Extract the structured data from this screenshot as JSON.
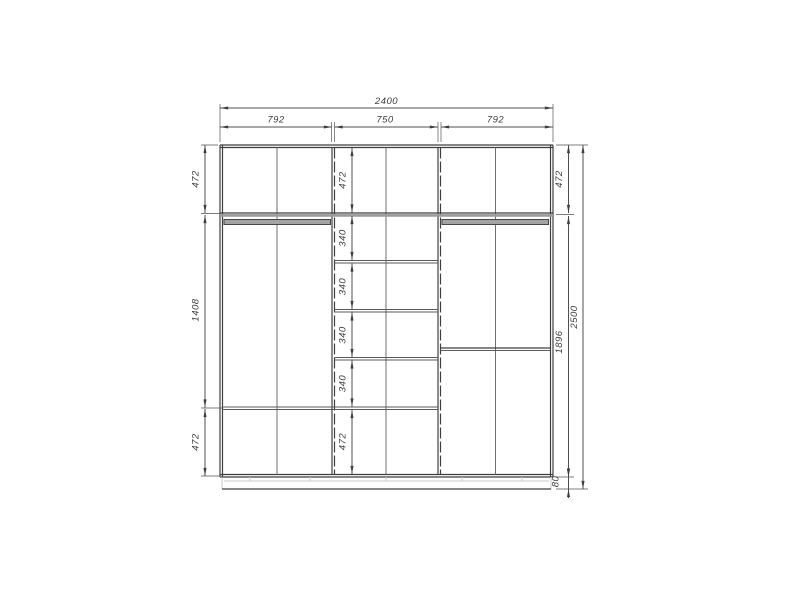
{
  "drawing": {
    "type": "wardrobe-front-elevation-dimension-drawing"
  },
  "colors": {
    "background": "#ffffff",
    "line": "#3f3f3f",
    "dim": "#4f4f4f",
    "ext": "#7d7d7d",
    "shelf": "#9a9a9a",
    "rod": "#a3a3a3",
    "light": "#c9c9c9",
    "text": "#3c3c3c"
  },
  "dimensions": {
    "overall_width": "2400",
    "overall_height": "2500",
    "top_sections": [
      "792",
      "750",
      "792"
    ],
    "left_chain": [
      "472",
      "1408",
      "472"
    ],
    "middle_chain": [
      "472",
      "340",
      "340",
      "340",
      "340",
      "472"
    ],
    "right_chain": [
      "472",
      "1896",
      "80"
    ]
  }
}
